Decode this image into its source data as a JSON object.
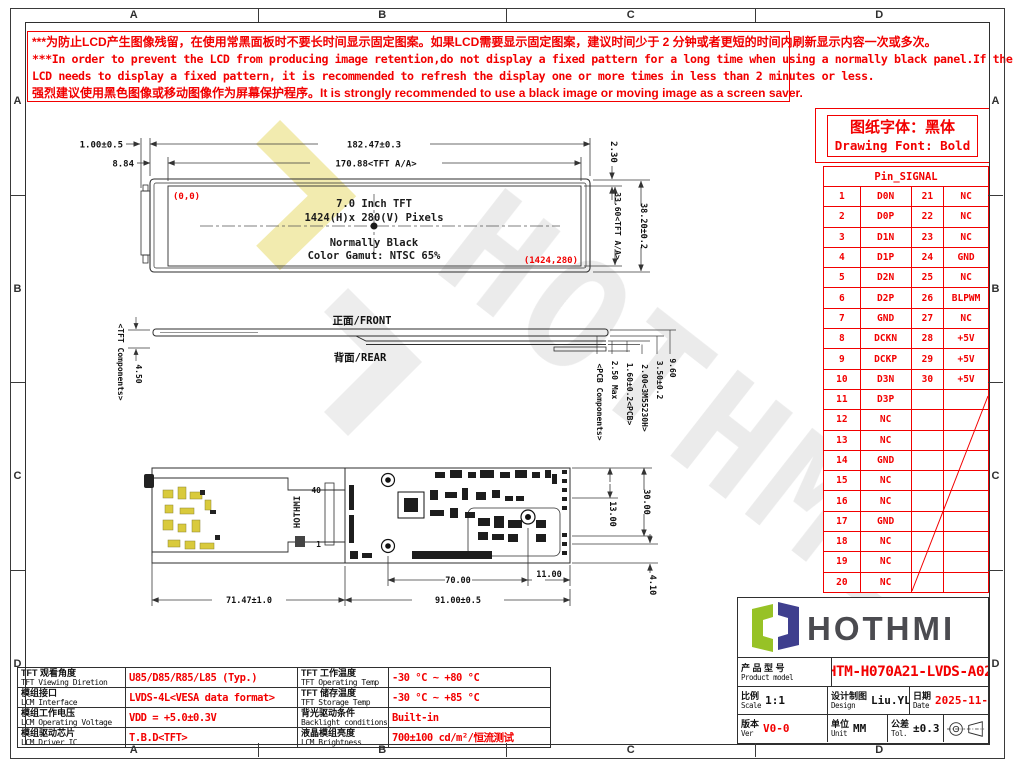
{
  "frame": {
    "letters": [
      "A",
      "B",
      "C",
      "D"
    ]
  },
  "warning": {
    "lines_cn_1": "***为防止LCD产生图像残留，在使用常黑面板时不要长时间显示固定图案。如果LCD需要显示固定图案，建议时间少于 2 分钟或者更短的时间内刷新显示内容一次或多次。",
    "lines_en_1": "***In order to prevent the LCD from producing image retention,do not display a fixed pattern for a long time when using a normally black panel.If the",
    "lines_en_2": "LCD needs to display a fixed pattern, it is recommended to refresh the display one or more times in less than 2 minutes or less.",
    "lines_cn_2": "强烈建议使用黑色图像或移动图像作为屏幕保护程序。It is strongly recommended to use a black image or moving image as a screen saver."
  },
  "font_note": {
    "cn": "图纸字体：黑体",
    "en": "Drawing Font: Bold"
  },
  "pin_table": {
    "title": "Pin_SIGNAL",
    "rows": [
      {
        "p1": "1",
        "s1": "D0N",
        "p2": "21",
        "s2": "NC"
      },
      {
        "p1": "2",
        "s1": "D0P",
        "p2": "22",
        "s2": "NC"
      },
      {
        "p1": "3",
        "s1": "D1N",
        "p2": "23",
        "s2": "NC"
      },
      {
        "p1": "4",
        "s1": "D1P",
        "p2": "24",
        "s2": "GND"
      },
      {
        "p1": "5",
        "s1": "D2N",
        "p2": "25",
        "s2": "NC"
      },
      {
        "p1": "6",
        "s1": "D2P",
        "p2": "26",
        "s2": "BLPWM"
      },
      {
        "p1": "7",
        "s1": "GND",
        "p2": "27",
        "s2": "NC"
      },
      {
        "p1": "8",
        "s1": "DCKN",
        "p2": "28",
        "s2": "+5V"
      },
      {
        "p1": "9",
        "s1": "DCKP",
        "p2": "29",
        "s2": "+5V"
      },
      {
        "p1": "10",
        "s1": "D3N",
        "p2": "30",
        "s2": "+5V"
      },
      {
        "p1": "11",
        "s1": "D3P",
        "p2": "",
        "s2": ""
      },
      {
        "p1": "12",
        "s1": "NC",
        "p2": "",
        "s2": ""
      },
      {
        "p1": "13",
        "s1": "NC",
        "p2": "",
        "s2": ""
      },
      {
        "p1": "14",
        "s1": "GND",
        "p2": "",
        "s2": ""
      },
      {
        "p1": "15",
        "s1": "NC",
        "p2": "",
        "s2": ""
      },
      {
        "p1": "16",
        "s1": "NC",
        "p2": "",
        "s2": ""
      },
      {
        "p1": "17",
        "s1": "GND",
        "p2": "",
        "s2": ""
      },
      {
        "p1": "18",
        "s1": "NC",
        "p2": "",
        "s2": ""
      },
      {
        "p1": "19",
        "s1": "NC",
        "p2": "",
        "s2": ""
      },
      {
        "p1": "20",
        "s1": "NC",
        "p2": "",
        "s2": ""
      }
    ]
  },
  "front_view": {
    "origin": "(0,0)",
    "corner": "(1424,280)",
    "line1": "7.0 Inch TFT",
    "line2": "1424(H)x 280(V) Pixels",
    "line3": "Normally Black",
    "line4": "Color Gamut: NTSC 65%",
    "dims": {
      "tab": "1.00±0.5",
      "offset": "8.84",
      "overall_w": "182.47±0.3",
      "aa_w": "170.88<TFT A/A>",
      "top_edge": "2.30",
      "aa_h": "33.60<TFT A/A>",
      "overall_h": "38.20±0.2"
    }
  },
  "side_view": {
    "front": "正面/FRONT",
    "rear": "背面/REAR",
    "tft_comp": "<TFT Components>",
    "tft_h": "4.50",
    "labels": [
      "<PCB Components>",
      "2.50 Max",
      "1.60±0.2<PCB>",
      "2.00<3M55230H>",
      "3.50±0.2",
      "9.60"
    ]
  },
  "rear_view": {
    "logo": "HOTHMI",
    "pin_top": "40",
    "pin_bottom": "1",
    "dims": {
      "holes_w": "70.00",
      "right_w": "11.00",
      "flex_w": "71.47±1.0",
      "pcb_w": "91.00±0.5",
      "h1": "13.00",
      "h2": "30.00",
      "h3": "4.10"
    }
  },
  "spec_table": {
    "rows": [
      {
        "l1": {
          "cn": "TFT 观看角度",
          "en": "TFT Viewing Diretion"
        },
        "v1": "U85/D85/R85/L85 (Typ.)",
        "l2": {
          "cn": "TFT 工作温度",
          "en": "TFT Operating Temp"
        },
        "v2": "-30 °C ~ +80 °C"
      },
      {
        "l1": {
          "cn": "模组接口",
          "en": "LCM Interface"
        },
        "v1": "LVDS-4L<VESA data format>",
        "l2": {
          "cn": "TFT 储存温度",
          "en": "TFT Storage Temp"
        },
        "v2": "-30 °C ~ +85 °C"
      },
      {
        "l1": {
          "cn": "模组工作电压",
          "en": "LCM Operating Voltage"
        },
        "v1": "VDD = +5.0±0.3V",
        "l2": {
          "cn": "背光驱动条件",
          "en": "Backlight conditions"
        },
        "v2": "Built-in"
      },
      {
        "l1": {
          "cn": "模组驱动芯片",
          "en": "LCM Driver IC"
        },
        "v1": "T.B.D<TFT>",
        "l2": {
          "cn": "液晶模组亮度",
          "en": "LCM Brightness"
        },
        "v2": "700±100  cd/m²/恒流测试"
      }
    ]
  },
  "title_block": {
    "logo_text": "HOTHMI",
    "product_label_cn": "产 品 型 号",
    "product_label_en": "Product model",
    "product_model": "HTM-H070A21-LVDS-A02",
    "scale_cn": "比例",
    "scale_en": "Scale",
    "scale_val": "1:1",
    "design_cn": "设计制图",
    "design_en": "Design",
    "design_val": "Liu.YL",
    "date_cn": "日期",
    "date_en": "Date",
    "date_val": "2025-11-19",
    "ver_cn": "版本",
    "ver_en": "Ver",
    "ver_val": "V0-0",
    "unit_cn": "单位",
    "unit_en": "Unit",
    "unit_val": "MM",
    "tol_cn": "公差",
    "tol_en": "Tol.",
    "tol_val": "±0.3"
  },
  "colors": {
    "red": "#f20000",
    "line": "#333333",
    "logo_green": "#97c226",
    "logo_navy": "#3f3f8e",
    "flex_yellow": "#d9ca3c"
  }
}
